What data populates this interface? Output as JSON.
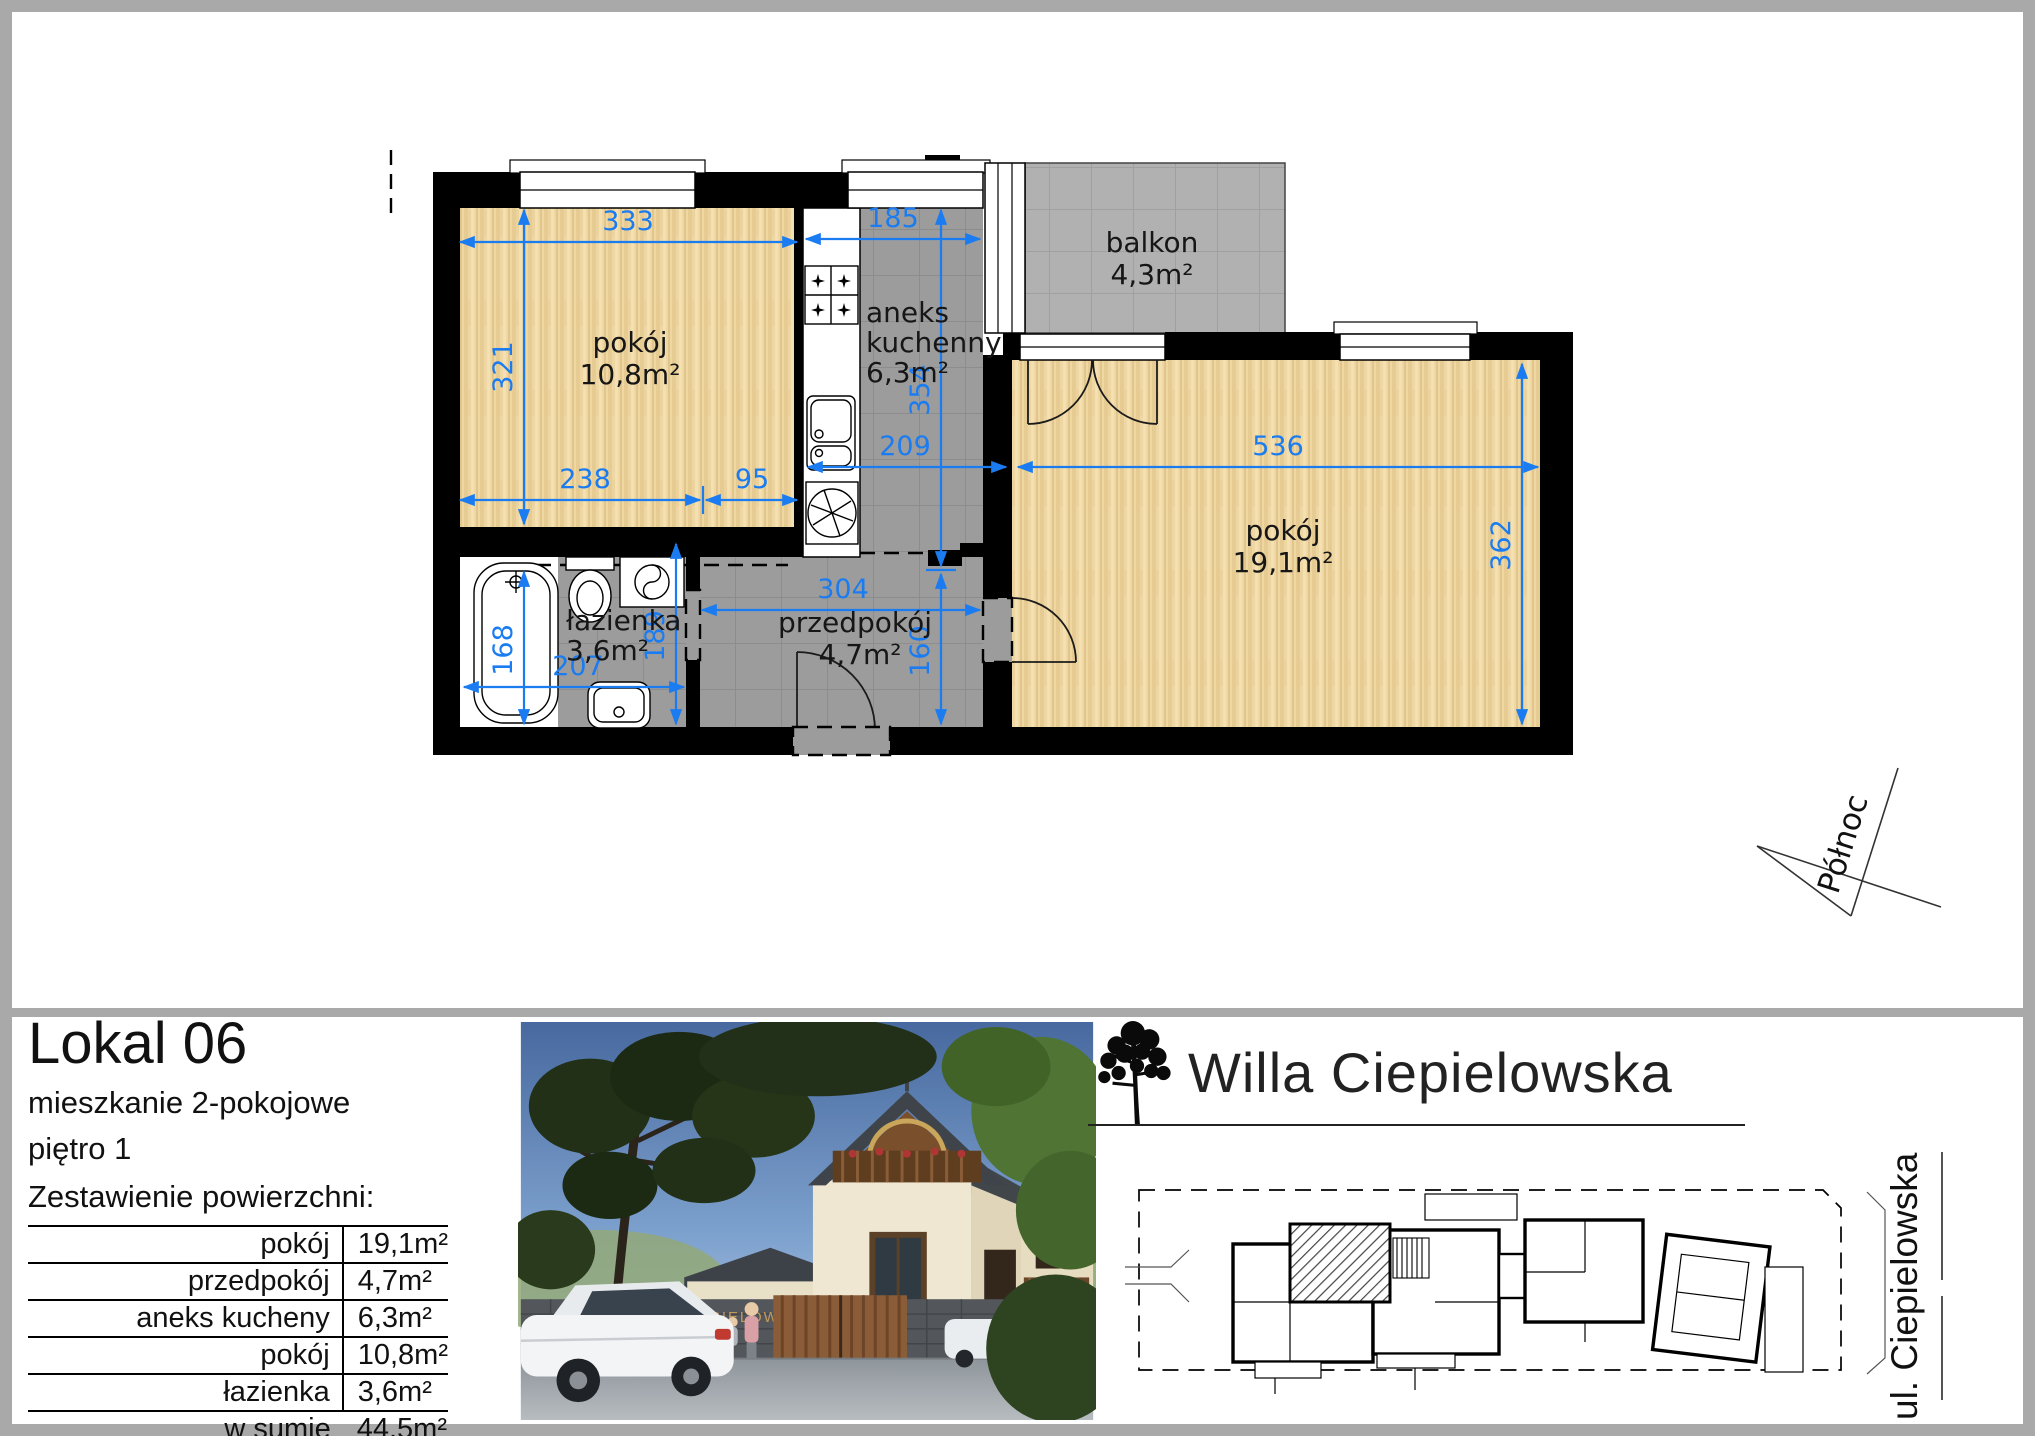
{
  "page": {
    "background": "#ffffff",
    "frame_color": "#a9a9a9"
  },
  "floorplan": {
    "dimension_color": "#1a7cf0",
    "north_label": "Północ",
    "rooms": {
      "room1": {
        "name": "pokój",
        "area": "10,8m²"
      },
      "kitchen": {
        "name_line1": "aneks",
        "name_line2": "kuchenny",
        "area": "6,3m²"
      },
      "balcony": {
        "name": "balkon",
        "area": "4,3m²"
      },
      "room2": {
        "name": "pokój",
        "area": "19,1m²"
      },
      "bathroom": {
        "name": "łazienka",
        "area": "3,6m²"
      },
      "hall": {
        "name": "przedpokój",
        "area": "4,7m²"
      }
    },
    "dims": {
      "room1_width": "333",
      "room1_height": "321",
      "room1_b1": "238",
      "room1_b2": "95",
      "kitchen_width": "185",
      "kitchen_height": "354",
      "kitchen_pass": "209",
      "room2_width": "536",
      "room2_height": "362",
      "bath_height": "168",
      "bath_width": "207",
      "bath_right": "189",
      "hall_width": "304",
      "hall_height": "160"
    }
  },
  "unit": {
    "title": "Lokal 06",
    "subtitle": "mieszkanie 2-pokojowe",
    "floor": "piętro 1",
    "areas_heading": "Zestawienie powierzchni:",
    "area_rows": [
      {
        "label": "pokój",
        "value": "19,1m²"
      },
      {
        "label": "przedpokój",
        "value": "4,7m²"
      },
      {
        "label": "aneks kucheny",
        "value": "6,3m²"
      },
      {
        "label": "pokój",
        "value": "10,8m²"
      },
      {
        "label": "łazienka",
        "value": "3,6m²"
      }
    ],
    "summary_rows": [
      {
        "label": "w sumie",
        "value": "44,5m²"
      },
      {
        "label": "+ balkon",
        "value": "4,3m²"
      }
    ]
  },
  "branding": {
    "logo_text": "Willa Ciepielowska",
    "street_label": "ul. Ciepielowska",
    "gate_sign": "CIEPIELOWSKA 10"
  }
}
